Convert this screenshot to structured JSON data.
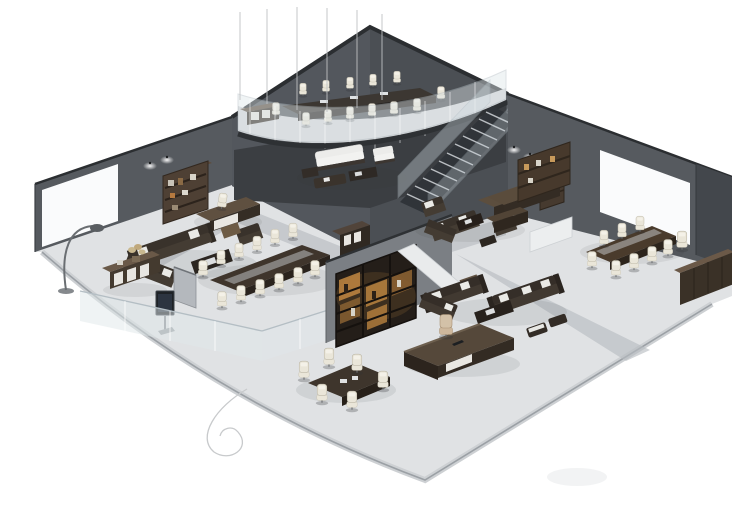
{
  "image": {
    "kind": "3d-isometric-office-interior-render",
    "background": "#ffffff",
    "levels": 2,
    "areas": [
      "mezzanine-conference-room",
      "under-mezzanine-lounge",
      "staircase",
      "left-lounge-area",
      "left-executive-desk-area",
      "middle-conference-area",
      "media-wall-area",
      "front-executive-office",
      "front-sofa-lounge",
      "upper-right-sofa-lounge",
      "right-conference-room",
      "small-meeting-area"
    ]
  },
  "palette": {
    "bg": "#ffffff",
    "wall": "#565a5f",
    "wallDark": "#4b4f54",
    "wallDarker": "#3b3e42",
    "wallEdge": "#2b2e31",
    "panel": "#fafbfc",
    "floor": "#e0e2e4",
    "walkway": "#b7bbc0",
    "mezzFloor": "#d6d8da",
    "glass": "#dfe7ea",
    "glassEdge": "#b4bec4",
    "wood": "#5a4b3b",
    "woodMid": "#44382d",
    "woodDark": "#332b23",
    "sofa": "#39322b",
    "sofaSeat": "#443c33",
    "cushion": "#eaeae6",
    "cream": "#eae6d9",
    "tan": "#cdb79c",
    "amber": "#b9823f",
    "amberGlow": "#c08a45",
    "metal": "#9aa0a5",
    "screen": "#1e2226"
  }
}
